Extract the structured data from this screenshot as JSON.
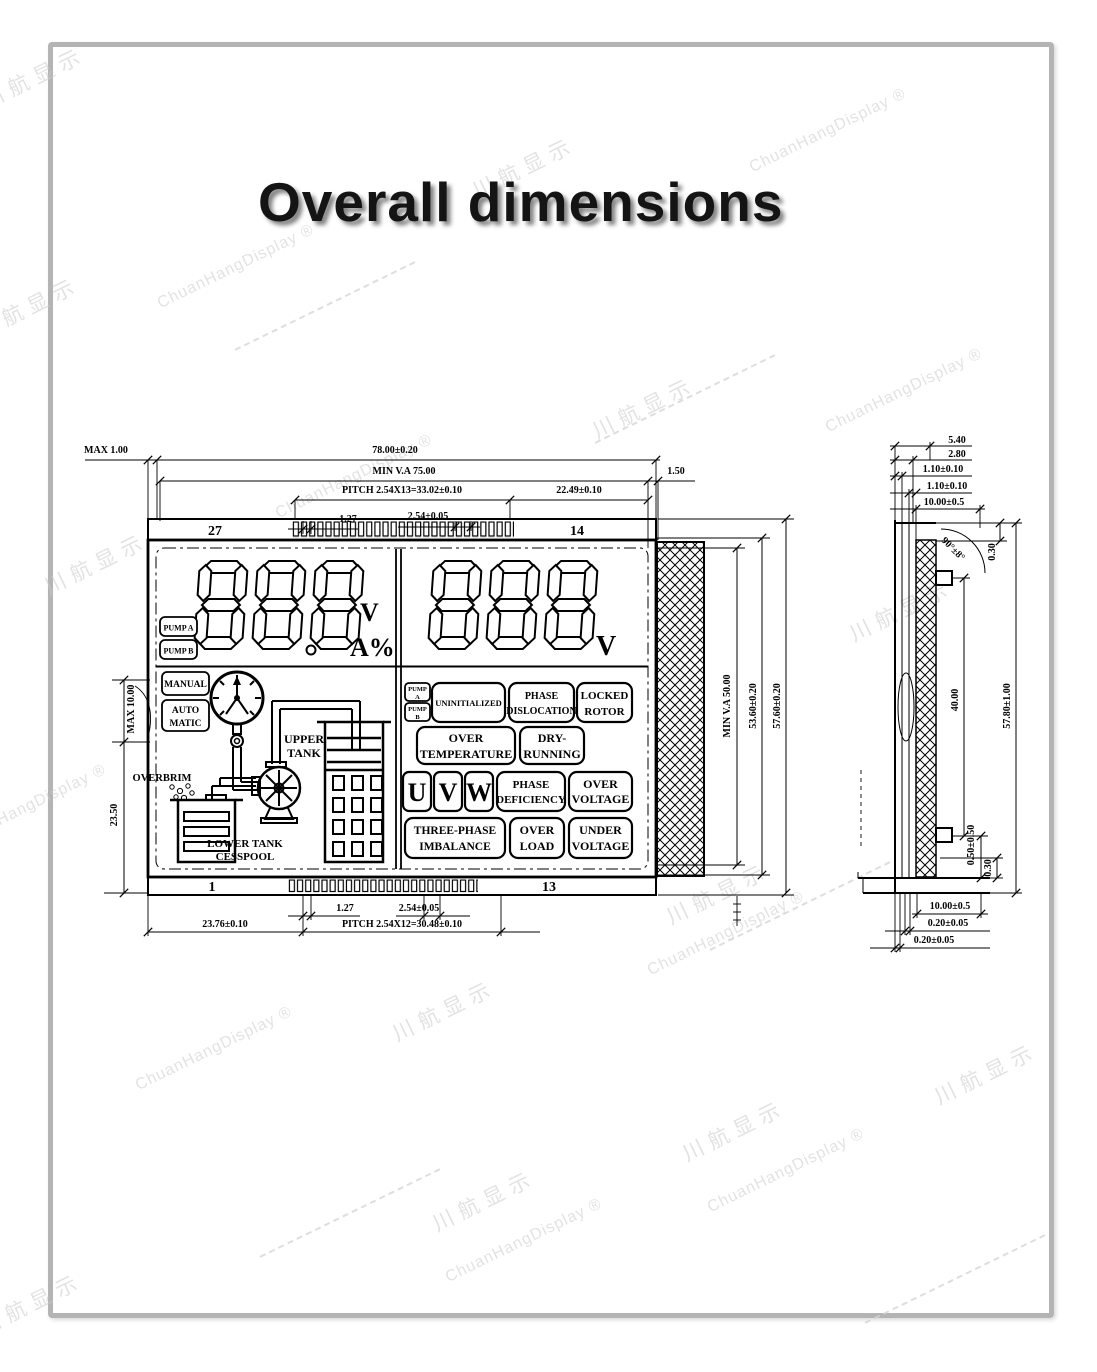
{
  "title": "Overall dimensions",
  "watermark": {
    "cn": "川航显示",
    "en": "ChuanHangDisplay ®"
  },
  "front": {
    "pins": {
      "top_left": "27",
      "top_right": "14",
      "bottom_left": "1",
      "bottom_right": "13"
    },
    "dims": {
      "max_edge": "MAX 1.00",
      "width": "78.00±0.20",
      "min_va_w": "MIN V.A 75.00",
      "edge_r": "1.50",
      "pitch_top": "PITCH 2.54X13=33.02±0.10",
      "span_r": "22.49±0.10",
      "half_pitch_top": "1.27",
      "pin_pitch_top": "2.54±0.05",
      "half_pitch_bot": "1.27",
      "pin_pitch_bot": "2.54±0.05",
      "span_l_bot": "23.76±0.10",
      "pitch_bot": "PITCH 2.54X12=30.48±0.10",
      "tab_l": "MAX 10.00",
      "height_l": "23.50",
      "min_va_h": "MIN V.A 50.00",
      "va_h": "53.60±0.20",
      "height": "57.60±0.20"
    }
  },
  "lcd": {
    "left_value": "888",
    "left_unit1": "V",
    "left_unit2": "A%",
    "right_value": "888",
    "right_unit": "V",
    "pump_a": "PUMP A",
    "pump_b": "PUMP B",
    "manual": "MANUAL",
    "auto1": "AUTO",
    "auto2": "MATIC",
    "upper1": "UPPER",
    "upper2": "TANK",
    "overbrim": "OVERBRIM",
    "lower1": "LOWER TANK",
    "lower2": "CESSPOOL",
    "sm_pump_a1": "PUMP",
    "sm_pump_a2": "A",
    "sm_pump_b1": "PUMP",
    "sm_pump_b2": "B",
    "ann": {
      "uninitialized": "UNINITIALIZED",
      "phase1": "PHASE",
      "dislocation": "DISLOCATION",
      "locked": "LOCKED",
      "rotor": "ROTOR",
      "over1": "OVER",
      "temperature": "TEMPERATURE",
      "dry": "DRY-",
      "running": "RUNNING",
      "u": "U",
      "v": "V",
      "w": "W",
      "phase2": "PHASE",
      "deficiency": "DEFICIENCY",
      "over2": "OVER",
      "voltage1": "VOLTAGE",
      "threephase": "THREE-PHASE",
      "imbalance": "IMBALANCE",
      "over3": "OVER",
      "load": "LOAD",
      "under": "UNDER",
      "voltage2": "VOLTAGE"
    }
  },
  "side": {
    "dims": {
      "t1": "5.40",
      "t2": "2.80",
      "t3": "1.10±0.10",
      "t4": "1.10±0.10",
      "t5": "10.00±0.5",
      "angle": "90°±8°",
      "gap_top": "0.30",
      "pin_span": "40.00",
      "height": "57.80±1.00",
      "pin_bot": "0.50±0.50",
      "gap_bot": "0.30",
      "b1": "10.00±0.5",
      "b2": "0.20±0.05",
      "b3": "0.20±0.05"
    }
  }
}
